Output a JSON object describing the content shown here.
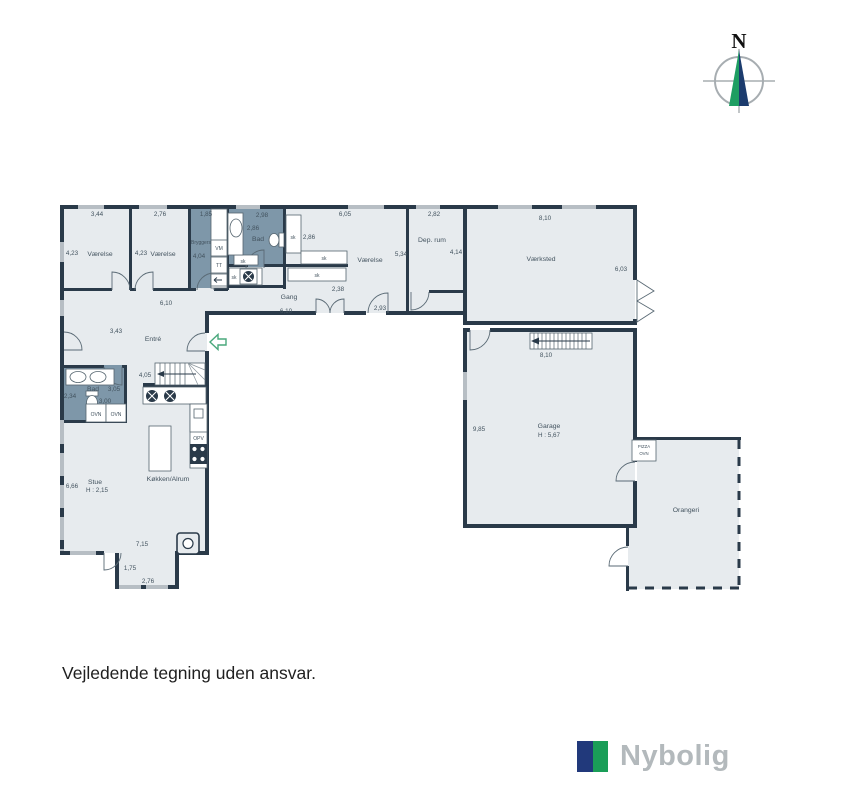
{
  "footer": {
    "disclaimer": "Vejledende tegning uden ansvar."
  },
  "brand": {
    "name": "Nybolig",
    "logo_navy": "#21397b",
    "logo_green": "#1a9e58"
  },
  "compass": {
    "north": "N"
  },
  "colors": {
    "wall": "#2a3a49",
    "floor": "#e7ebee",
    "wet_room": "#7e97a9",
    "window": "#b7bec4",
    "text": "#42525e",
    "entry_arrow": "#49a87c",
    "compass_green": "#1e9e62",
    "compass_navy": "#1c3c6e"
  },
  "rooms": {
    "vaerelse1": {
      "label": "Værelse",
      "w": "3,44",
      "h": "4,23"
    },
    "vaerelse2": {
      "label": "Værelse",
      "w": "2,76",
      "h": "4,23"
    },
    "bryggers": {
      "label": "Bryggers",
      "w": "1,85",
      "h": "4,04"
    },
    "bad1": {
      "label": "Bad",
      "w": "2,98",
      "h": "2,86"
    },
    "vaerelse3": {
      "label": "Værelse",
      "w": "6,05",
      "h": "5,34",
      "closet_w": "2,86"
    },
    "dep_rum": {
      "label": "Dep. rum",
      "w": "2,82",
      "h": "4,14"
    },
    "vaerksted": {
      "label": "Værksted",
      "w": "8,10",
      "h": "6,03"
    },
    "garage": {
      "label": "Garage",
      "ceiling": "H : 5,67",
      "w": "8,10",
      "h": "9,85"
    },
    "orangeri": {
      "label": "Orangeri"
    },
    "gang": {
      "label": "Gang",
      "w": "6,10",
      "d2": "2,38",
      "d3": "2,93"
    },
    "hall": {
      "w": "6,10"
    },
    "entre": {
      "label": "Entré",
      "door_dim": "3,43",
      "stair_dim": "4,05"
    },
    "bad2": {
      "label": "Bad",
      "d1": "2,34",
      "d2": "3,05",
      "d3": "3,00"
    },
    "stue": {
      "label": "Stue",
      "ceiling": "H : 2,15",
      "h": "6,66",
      "d1": "7,15",
      "d2": "1,75",
      "d3": "2,76"
    },
    "koekken": {
      "label": "Køkken/Alrum"
    }
  },
  "fixtures": {
    "vm": "VM",
    "tt": "TT",
    "opv": "OPV",
    "ovn1": "OVN",
    "ovn2": "OVN",
    "pizza_line1": "PIZZA",
    "pizza_line2": "OVN",
    "sk": "sk"
  }
}
